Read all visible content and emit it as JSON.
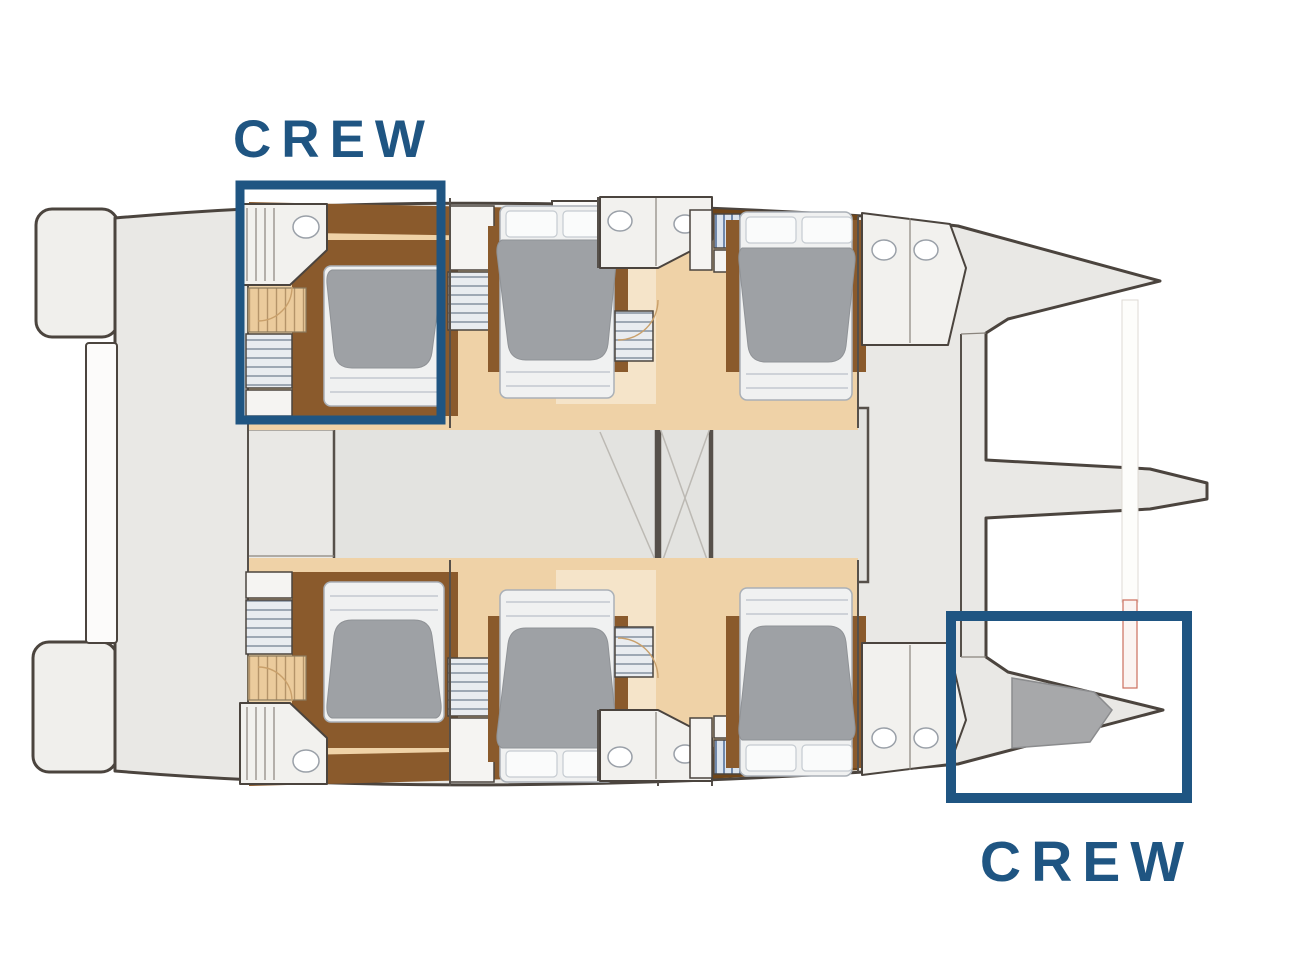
{
  "page": {
    "background": "#FFFFFF"
  },
  "diagram": {
    "type": "boat-deck-plan",
    "vessel": "catamaran",
    "view": "top-down floor plan, bow pointing right",
    "hulls": 2,
    "guest_cabins_visible": 6,
    "crew_areas_marked": 2
  },
  "annotations": {
    "crew_top": {
      "label": "CREW",
      "position": "port aft cabin (top-left)"
    },
    "crew_bottom": {
      "label": "CREW",
      "position": "starboard bow compartment (bottom-right)"
    }
  },
  "colors": {
    "accent_blue": "#1F5582",
    "outline_dark": "#4B443E",
    "hull_gray": "#E9E8E5",
    "salon_gray": "#E3E3E0",
    "floor_tan": "#EFD2A7",
    "floor_light": "#F5E4C9",
    "wood_brown": "#8A5A2C",
    "wood_dark": "#6F4519",
    "duvet_gray": "#9EA1A5",
    "bed_white": "#F0F1F1",
    "bath_white": "#F2F1EE",
    "platform_gray": "#F0EFEC",
    "page_bg": "#FFFFFF"
  }
}
